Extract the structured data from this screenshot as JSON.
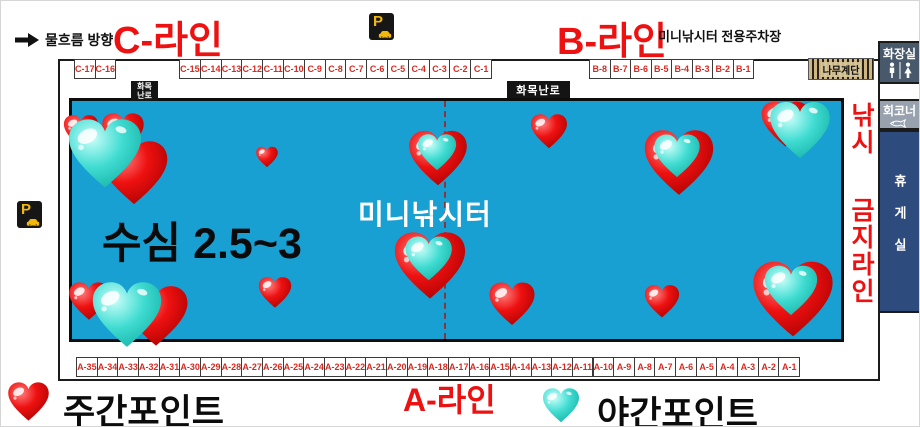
{
  "header": {
    "flow_label": "물흐름 방향",
    "c_line_title": "C-라인",
    "b_line_title": "B-라인",
    "parking_note": "미니낚시터 전용주차장",
    "stairs_label": "나무계단"
  },
  "icons": {
    "parking_letter": "P"
  },
  "cells": {
    "c_group1": [
      "C-17",
      "C-16"
    ],
    "c_group2": [
      "C-15",
      "C-14",
      "C-13",
      "C-12",
      "C-11",
      "C-10",
      "C-9",
      "C-8",
      "C-7",
      "C-6",
      "C-5",
      "C-4",
      "C-3",
      "C-2",
      "C-1"
    ],
    "b_group": [
      "B-8",
      "B-7",
      "B-6",
      "B-5",
      "B-4",
      "B-3",
      "B-2",
      "B-1"
    ],
    "a_group": [
      "A-35",
      "A-34",
      "A-33",
      "A-32",
      "A-31",
      "A-30",
      "A-29",
      "A-28",
      "A-27",
      "A-26",
      "A-25",
      "A-24",
      "A-23",
      "A-22",
      "A-21",
      "A-20",
      "A-19",
      "A-18",
      "A-17",
      "A-16",
      "A-15",
      "A-14",
      "A-13",
      "A-12",
      "A-11",
      "A-10",
      "A-9",
      "A-8",
      "A-7",
      "A-6",
      "A-5",
      "A-4",
      "A-3",
      "A-2",
      "A-1"
    ]
  },
  "pond": {
    "name": "미니낚시터",
    "depth_label": "수심 2.5~3",
    "stove_vertical_lines": [
      "화목",
      "난로"
    ],
    "stove_horizontal": "화목난로",
    "no_fishing_line1": "낚시",
    "no_fishing_line2": "금지라인"
  },
  "facilities": {
    "toilet": "화장실",
    "sashimi_corner": "회코너",
    "rest_room": "휴게실"
  },
  "legend": {
    "day_label": "주간포인트",
    "night_label": "야간포인트",
    "a_line_title": "A-라인",
    "day_heart": {
      "x": 27,
      "y": 401,
      "w": 45
    },
    "night_heart": {
      "x": 560,
      "y": 404,
      "w": 40
    }
  },
  "colors": {
    "pond_blue": "#18a0d2",
    "title_red": "#ee1111",
    "heart_red": "#ee1111",
    "heart_cyan": "#40dcd2",
    "rest_navy": "#2e4b7e",
    "toilet_slate": "#48596b",
    "corner_gray": "#97a2ae",
    "stairs_tan": "#cfb582"
  },
  "hearts": [
    {
      "x": 80,
      "y": 130,
      "w": 38,
      "kind": "day"
    },
    {
      "x": 122,
      "y": 132,
      "w": 46,
      "kind": "day"
    },
    {
      "x": 133,
      "y": 172,
      "w": 74,
      "kind": "day"
    },
    {
      "x": 104,
      "y": 153,
      "w": 80,
      "kind": "cyan"
    },
    {
      "x": 266,
      "y": 156,
      "w": 24,
      "kind": "day"
    },
    {
      "x": 437,
      "y": 157,
      "w": 64,
      "kind": "night"
    },
    {
      "x": 548,
      "y": 130,
      "w": 40,
      "kind": "day"
    },
    {
      "x": 678,
      "y": 162,
      "w": 76,
      "kind": "night"
    },
    {
      "x": 797,
      "y": 128,
      "w": 66,
      "kind": "night2"
    },
    {
      "x": 429,
      "y": 265,
      "w": 78,
      "kind": "night"
    },
    {
      "x": 511,
      "y": 303,
      "w": 50,
      "kind": "day"
    },
    {
      "x": 661,
      "y": 300,
      "w": 38,
      "kind": "day"
    },
    {
      "x": 792,
      "y": 298,
      "w": 88,
      "kind": "night"
    },
    {
      "x": 274,
      "y": 292,
      "w": 36,
      "kind": "day"
    },
    {
      "x": 88,
      "y": 300,
      "w": 44,
      "kind": "day"
    },
    {
      "x": 155,
      "y": 315,
      "w": 70,
      "kind": "day"
    },
    {
      "x": 126,
      "y": 314,
      "w": 76,
      "kind": "cyan"
    }
  ]
}
